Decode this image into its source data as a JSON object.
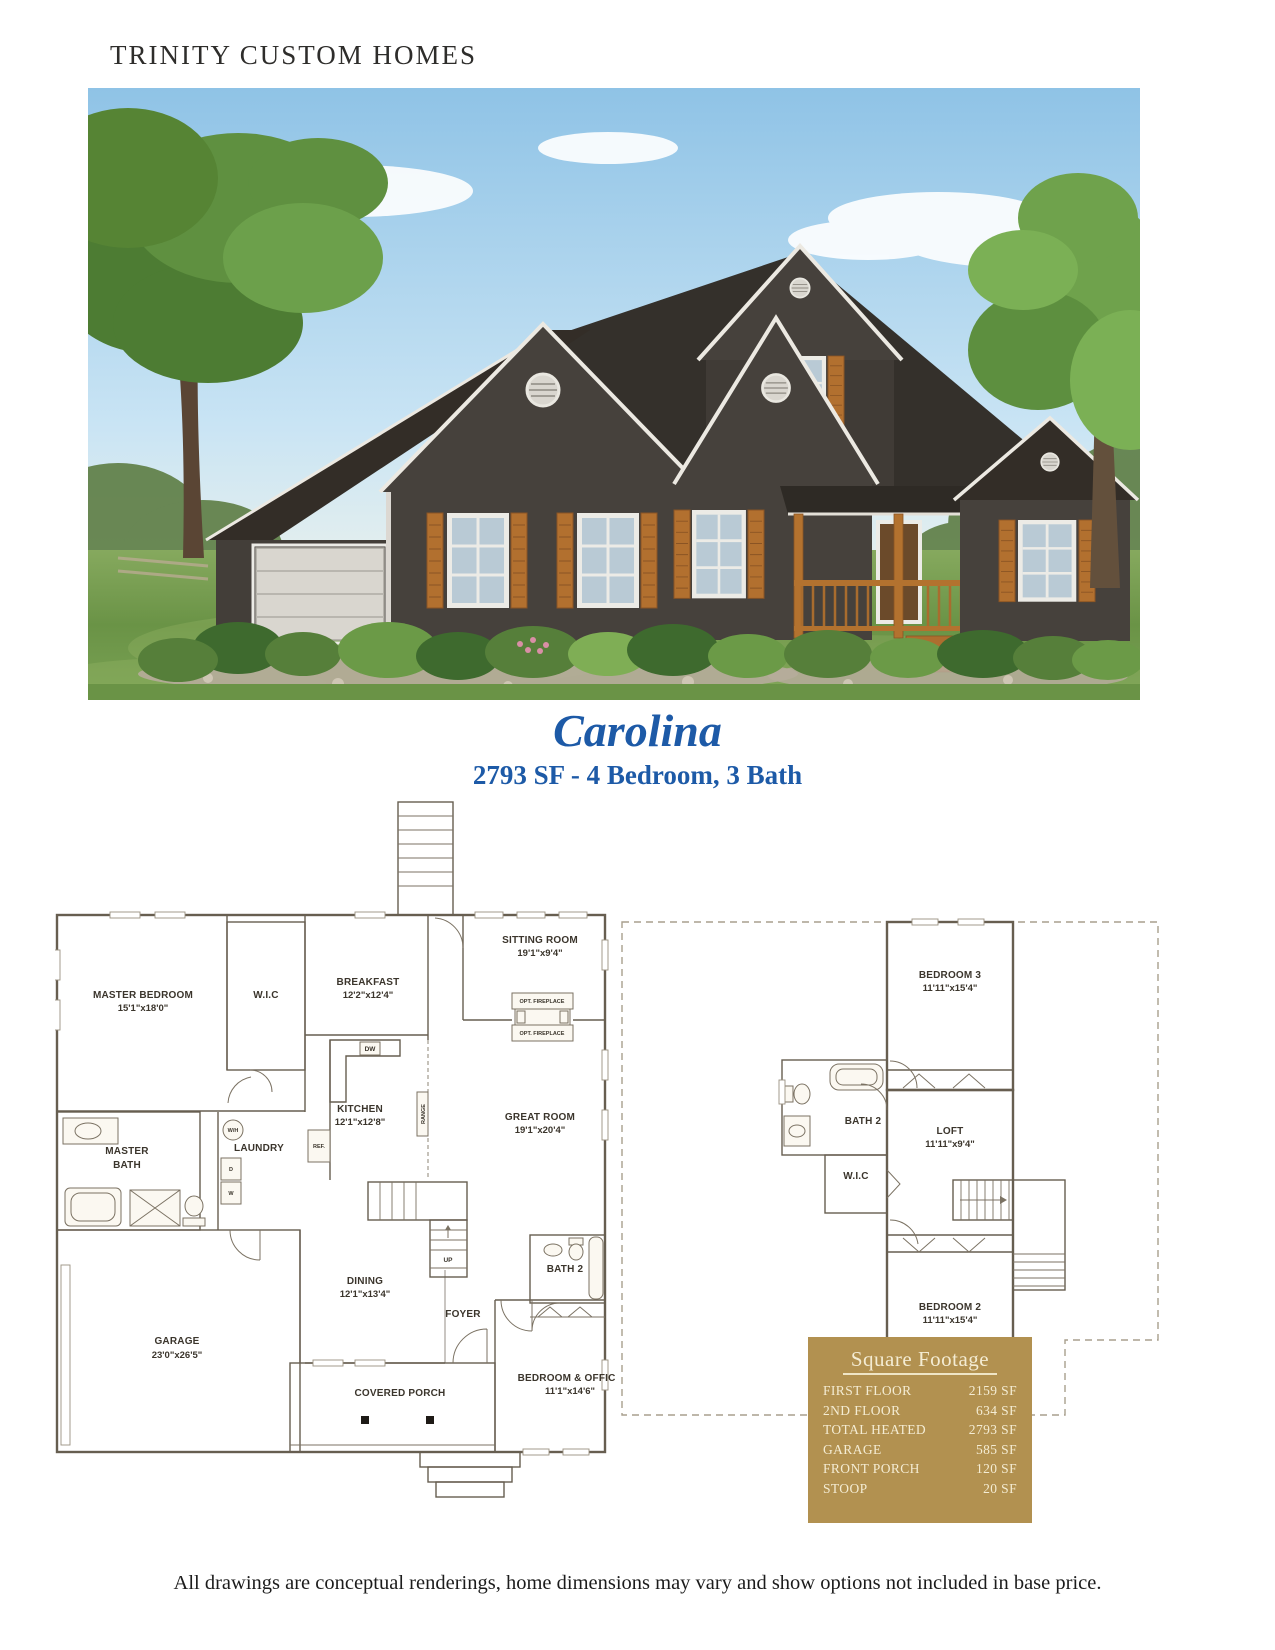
{
  "header": {
    "brand": "TRINITY CUSTOM HOMES"
  },
  "plan": {
    "name": "Carolina",
    "specs": "2793 SF - 4 Bedroom, 3 Bath"
  },
  "floor1": {
    "master_bedroom": {
      "name": "MASTER BEDROOM",
      "dims": "15'1\"x18'0\""
    },
    "wic": {
      "name": "W.I.C"
    },
    "breakfast": {
      "name": "BREAKFAST",
      "dims": "12'2\"x12'4\""
    },
    "sitting_room": {
      "name": "SITTING ROOM",
      "dims": "19'1\"x9'4\""
    },
    "fireplace_label": "OPT. FIREPLACE",
    "kitchen": {
      "name": "KITCHEN",
      "dims": "12'1\"x12'8\""
    },
    "great_room": {
      "name": "GREAT ROOM",
      "dims": "19'1\"x20'4\""
    },
    "master_bath": {
      "line1": "MASTER",
      "line2": "BATH"
    },
    "laundry": {
      "name": "LAUNDRY"
    },
    "dining": {
      "name": "DINING",
      "dims": "12'1\"x13'4\""
    },
    "foyer": {
      "name": "FOYER"
    },
    "bath2": {
      "name": "BATH 2"
    },
    "bedroom_office": {
      "name": "BEDROOM & OFFICE",
      "dims": "11'1\"x14'6\""
    },
    "garage": {
      "name": "GARAGE",
      "dims": "23'0\"x26'5\""
    },
    "covered_porch": {
      "name": "COVERED PORCH"
    },
    "stairs": {
      "label": "UP"
    },
    "appliances": {
      "wh": "W/H",
      "dryer": "D",
      "washer": "W",
      "ref": "REF.",
      "dw": "DW",
      "range": "RANGE"
    }
  },
  "floor2": {
    "bedroom3": {
      "name": "BEDROOM 3",
      "dims": "11'11\"x15'4\""
    },
    "bath2": {
      "name": "BATH 2"
    },
    "loft": {
      "name": "LOFT",
      "dims": "11'11\"x9'4\""
    },
    "wic": {
      "name": "W.I.C"
    },
    "bedroom2": {
      "name": "BEDROOM 2",
      "dims": "11'11\"x15'4\""
    }
  },
  "square_footage": {
    "title": "Square Footage",
    "rows": [
      {
        "label": "FIRST FLOOR",
        "value": "2159 SF"
      },
      {
        "label": "2ND FLOOR",
        "value": "634 SF"
      },
      {
        "label": "TOTAL HEATED",
        "value": "2793 SF"
      },
      {
        "label": "GARAGE",
        "value": "585 SF"
      },
      {
        "label": "FRONT PORCH",
        "value": "120 SF"
      },
      {
        "label": "STOOP",
        "value": "20 SF"
      }
    ]
  },
  "disclaimer": "All drawings are conceptual renderings, home dimensions may vary and show options not included in base price.",
  "colors": {
    "accent_blue": "#1d5aa7",
    "table_gold": "#b29150",
    "plan_beige": "#ecdfc0",
    "garage_gray": "#d7d2c6"
  }
}
